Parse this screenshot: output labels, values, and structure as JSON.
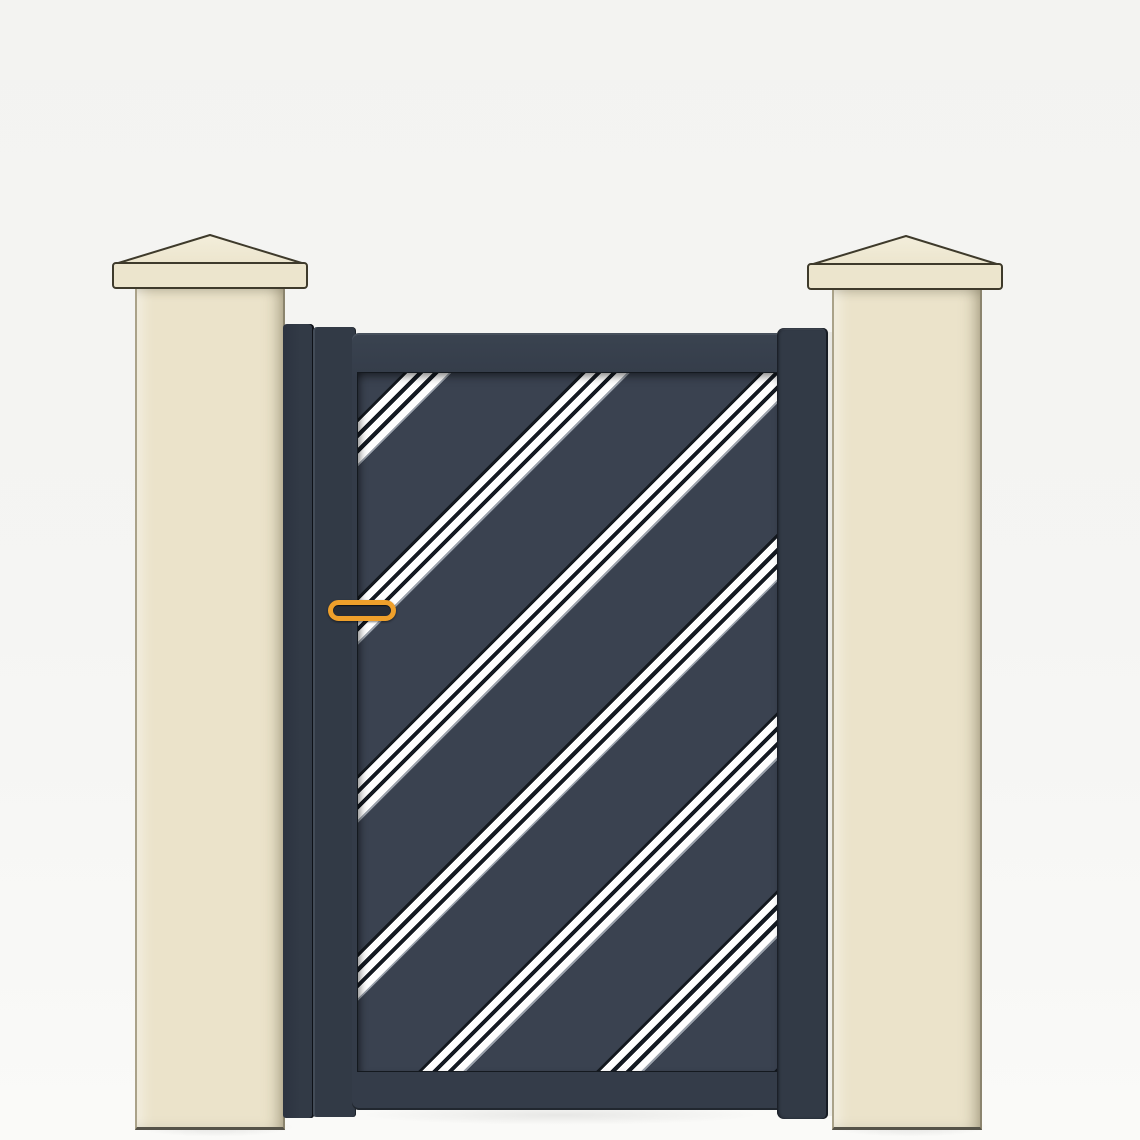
{
  "scene": {
    "type": "product-render",
    "description": "Anthracite aluminum pedestrian gate with diagonal triple-stripe decor, mounted between two cream masonry pillars with pyramid caps",
    "text_content": "none"
  },
  "objects": {
    "left_pillar": "cream masonry pillar with pyramid cap (left)",
    "right_pillar": "cream masonry pillar with pyramid cap (right)",
    "left_posts": "dark aluminum mounting posts fixed to left pillar",
    "right_stile": "dark aluminum gate stile / mounting post on right pillar",
    "gate_leaf": "gate leaf with top and bottom rails and diagonal striped infill panel",
    "stripes": "seven parallel diagonal bands, each made of three white lines, rising left to right",
    "handle": "orange pill-shaped handle on left side of gate leaf"
  },
  "colors": {
    "bg_top": "#f3f3f1",
    "bg_bottom": "#fafaf8",
    "pillar_fill": "#ebe3ca",
    "pillar_shade": "#ddd5ba",
    "pillar_light": "#f4efdd",
    "pillar_outline": "#3e3a2b",
    "cap_fill": "#ece5cd",
    "cap_highlight": "#f3eedb",
    "gate_frame": "#343c49",
    "gate_panel": "#3a4250",
    "gate_post": "#323a46",
    "gate_post_dark": "#2e3542",
    "seam": "#14191f",
    "stripe_white": "#ffffff",
    "stripe_dark": "#141a22",
    "stripe_fade": "#9aa1ab",
    "handle_orange": "#efa02b",
    "handle_inner": "#272d37",
    "shadow": "#00000018"
  }
}
